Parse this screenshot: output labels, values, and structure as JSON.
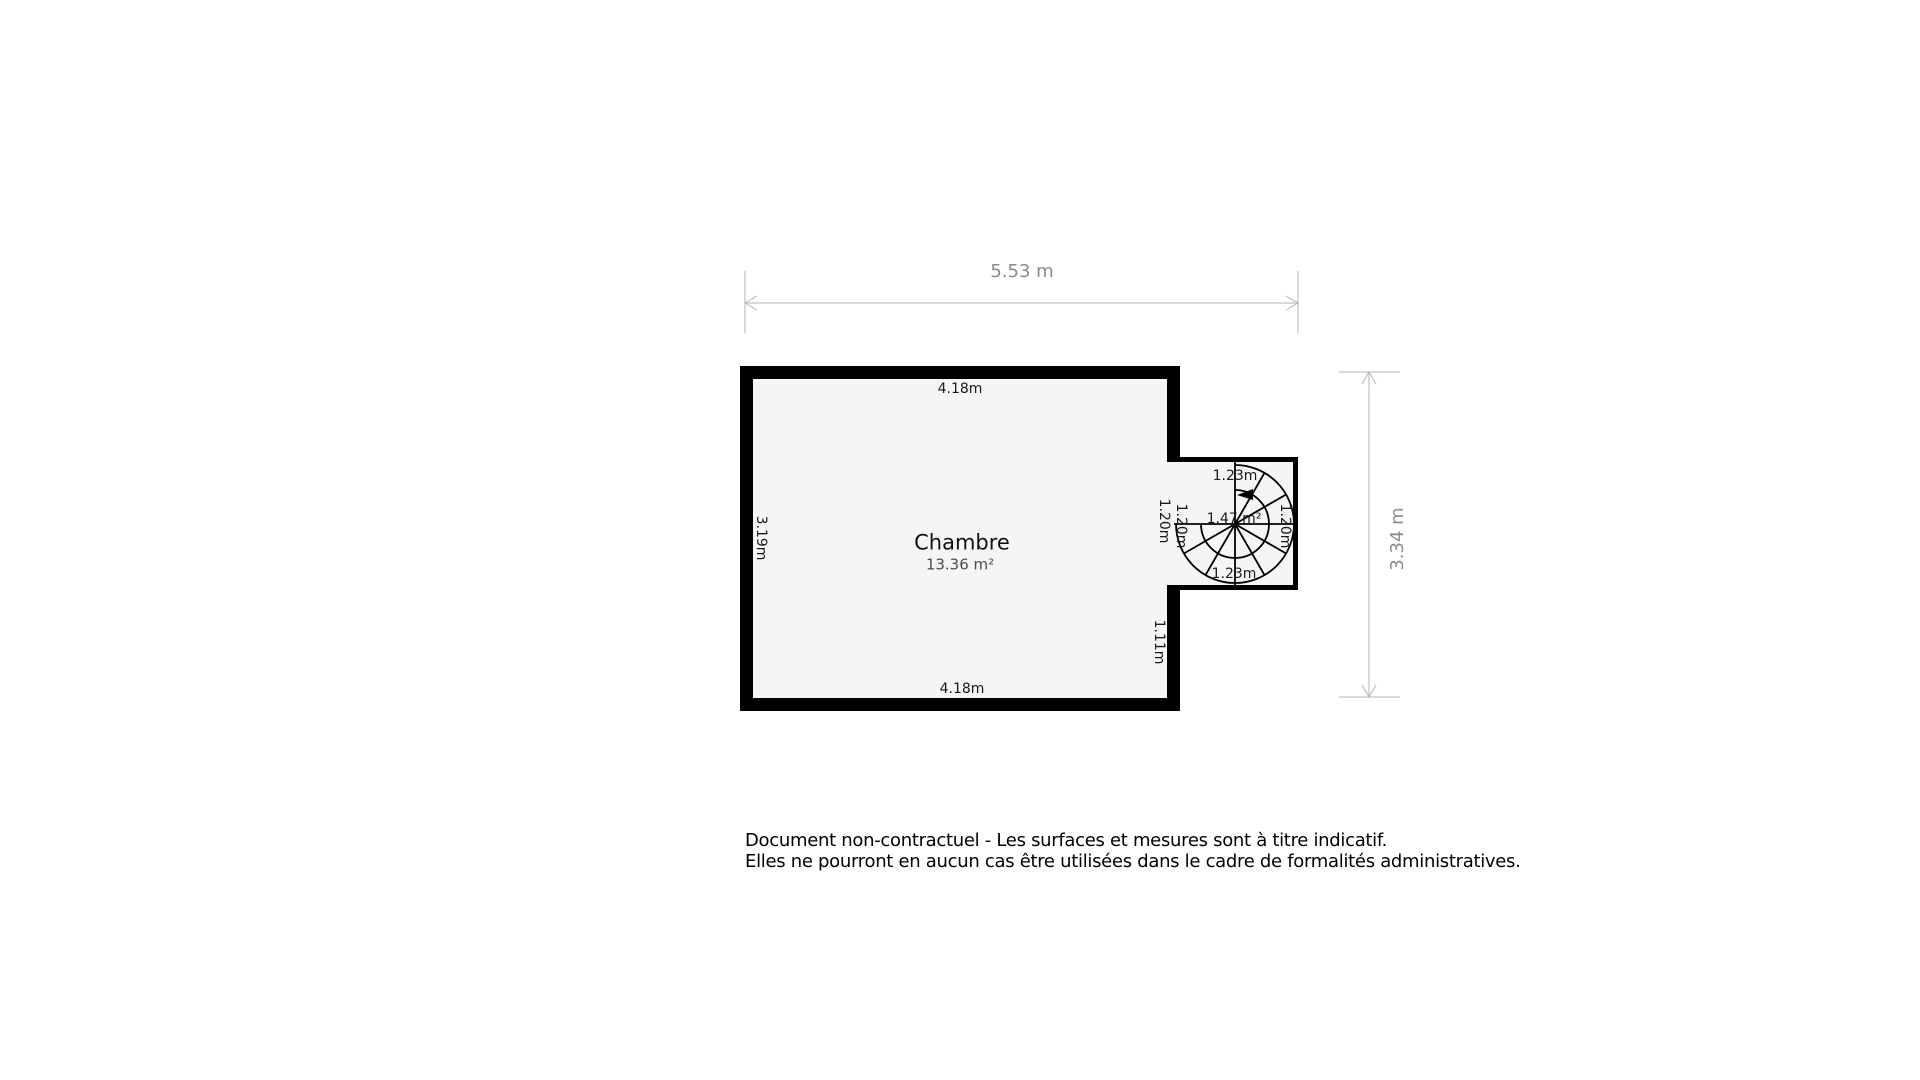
{
  "floorplan": {
    "room": {
      "name": "Chambre",
      "area": "13.36 m²"
    },
    "overall_dimensions": {
      "width": "5.53 m",
      "height": "3.34 m"
    },
    "wall_labels": {
      "top": "4.18m",
      "bottom": "4.18m",
      "left": "3.19m",
      "opening_outer": "1.20m",
      "opening_inner": "1.20m",
      "lower_right": "1.11m"
    },
    "staircase": {
      "width_top": "1.23m",
      "width_bottom": "1.23m",
      "area": "1.47 m²",
      "depth_right": "1.20m"
    }
  },
  "disclaimer": {
    "line1": "Document non-contractuel - Les surfaces et mesures sont à titre indicatif.",
    "line2": "Elles ne pourront en aucun cas être utilisées dans le cadre de formalités administratives."
  },
  "colors": {
    "wall": "#000000",
    "floor": "#f5f5f5",
    "dimension_line": "#b3b3b3",
    "dimension_text": "#8c8c8c",
    "label_text": "#1a1a1a",
    "area_text": "#4d4d4d"
  }
}
